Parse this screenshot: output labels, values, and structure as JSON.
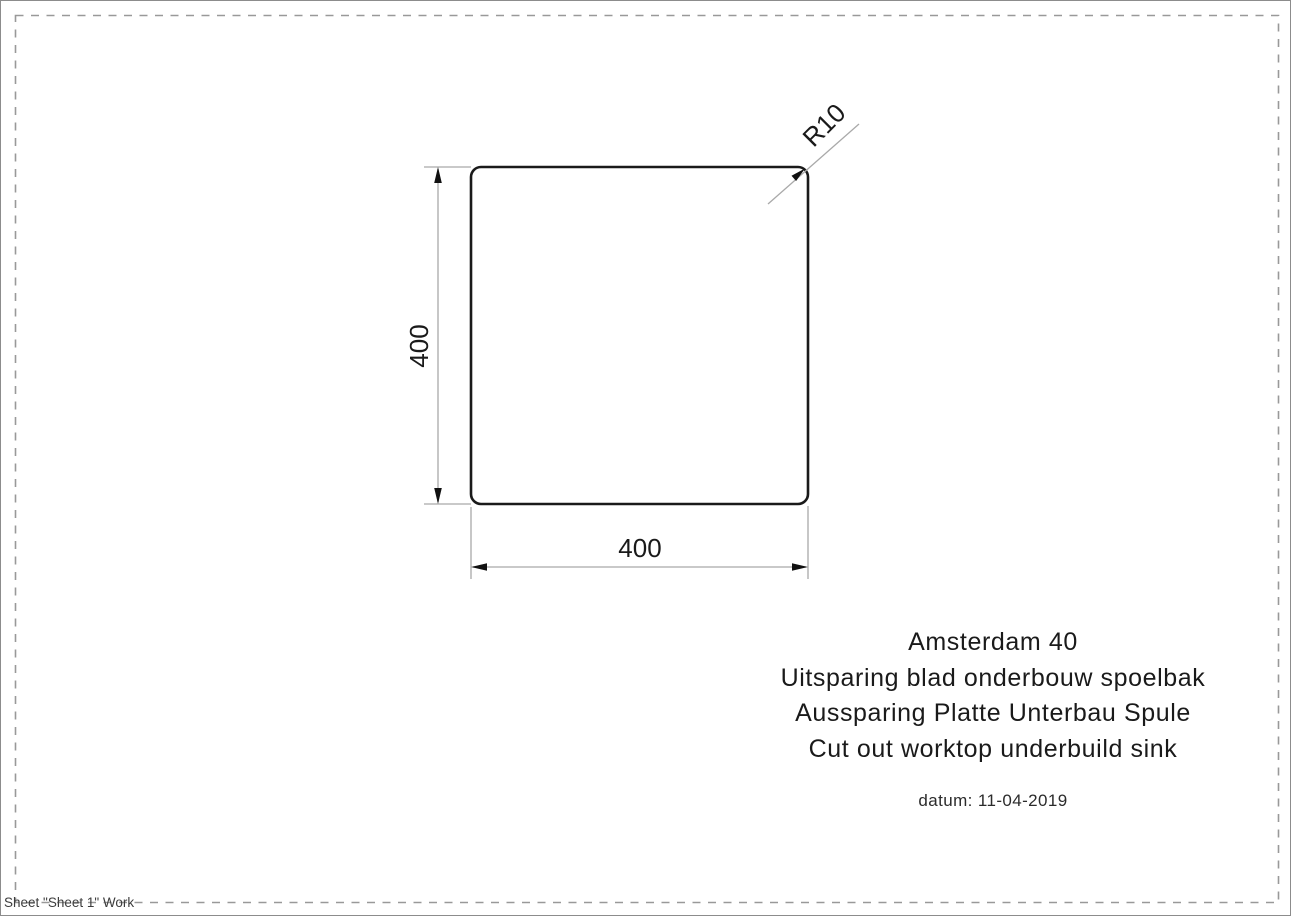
{
  "sheet": {
    "label": "Sheet \"Sheet 1\" Work"
  },
  "drawing": {
    "shape": "rounded-square-cutout",
    "width_dim": "400",
    "height_dim": "400",
    "radius_dim": "R10"
  },
  "title_block": {
    "lines": [
      "Amsterdam 40",
      "Uitsparing blad onderbouw spoelbak",
      "Aussparing Platte Unterbau Spule",
      "Cut out worktop underbuild sink"
    ],
    "date": "datum: 11-04-2019"
  },
  "colors": {
    "drawing_line": "#1a1a1a",
    "dim_line": "#a9a9a9",
    "arrow_fill": "#111111",
    "dash_border": "#999999",
    "outer_border": "#8c8c8c"
  }
}
